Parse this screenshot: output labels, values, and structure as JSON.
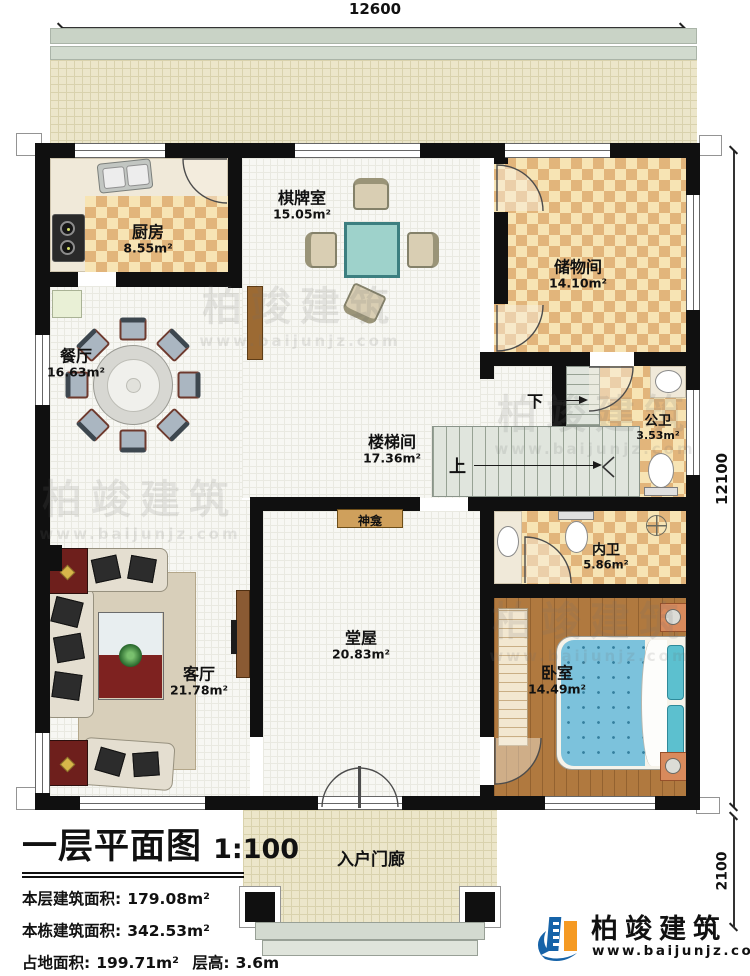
{
  "plan": {
    "dimensions": {
      "top_width": "12600",
      "right_height": "12100",
      "porch_height": "2100"
    },
    "rooms": {
      "kitchen": {
        "name": "厨房",
        "area": "8.55m²"
      },
      "chess_room": {
        "name": "棋牌室",
        "area": "15.05m²"
      },
      "storage": {
        "name": "储物间",
        "area": "14.10m²"
      },
      "dining": {
        "name": "餐厅",
        "area": "16.63m²"
      },
      "stairwell": {
        "name": "楼梯间",
        "area": "17.36m²"
      },
      "public_bath": {
        "name": "公卫",
        "area": "3.53m²"
      },
      "inner_bath": {
        "name": "内卫",
        "area": "5.86m²"
      },
      "bedroom": {
        "name": "卧室",
        "area": "14.49m²"
      },
      "hall": {
        "name": "堂屋",
        "area": "20.83m²"
      },
      "living": {
        "name": "客厅",
        "area": "21.78m²"
      },
      "porch": {
        "name": "入户门廊"
      }
    },
    "annotations": {
      "up": "上",
      "down": "下",
      "shrine": "神龛"
    }
  },
  "title_block": {
    "title": "一层平面图",
    "scale": "1:100",
    "floor_area_label": "本层建筑面积:",
    "floor_area": "179.08m²",
    "total_area_label": "本栋建筑面积:",
    "total_area": "342.53m²",
    "land_area_label": "占地面积:",
    "land_area": "199.71m²",
    "story_height_label": "层高:",
    "story_height": "3.6m"
  },
  "brand": {
    "name": "柏竣建筑",
    "url": "www.baijunjz.com"
  },
  "watermark": {
    "name": "柏竣建筑",
    "url": "www.baijunjz.com"
  },
  "colors": {
    "wall": "#111111",
    "checker_dark": "#e2b57b",
    "checker_light": "#f7e4b4",
    "brand_blue": "#1663a8",
    "brand_orange": "#f59a23",
    "stair": "#e0e5dd",
    "wood": "#b0793f"
  }
}
